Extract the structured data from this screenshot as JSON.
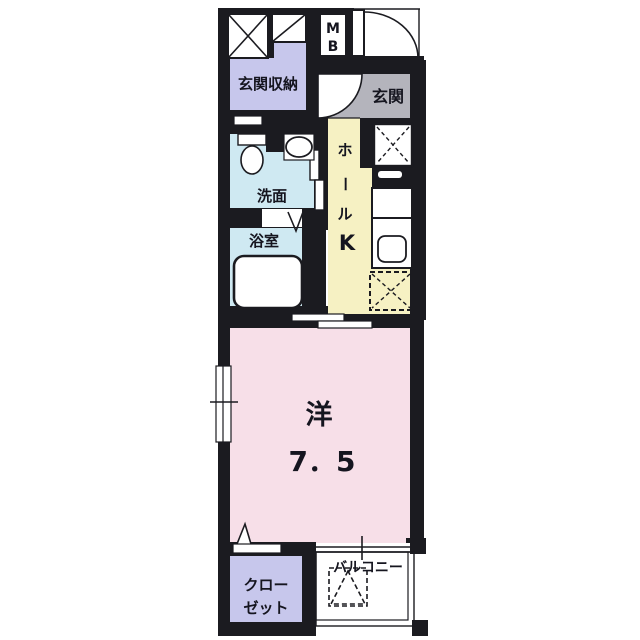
{
  "title": "apartment-floorplan",
  "colors": {
    "wall": "#1b1b20",
    "lavender": "#c7c7ec",
    "gray": "#b4b4bc",
    "blue": "#cfe9f2",
    "yellow": "#f6f1c3",
    "pink": "#f7dfe8",
    "white": "#ffffff",
    "text": "#15151f"
  },
  "rooms": {
    "entrance_storage": {
      "label": "玄関収納"
    },
    "meter_box": {
      "letter_m": "M",
      "letter_b": "B"
    },
    "entrance": {
      "label": "玄関"
    },
    "washroom": {
      "label": "洗面"
    },
    "bathroom": {
      "label": "浴室"
    },
    "hall": {
      "char1": "ホ",
      "char2": "ー",
      "char3": "ル"
    },
    "kitchen": {
      "label": "K"
    },
    "western_room": {
      "label": "洋",
      "size": "7．5"
    },
    "closet": {
      "line1": "クロー",
      "line2": "ゼット"
    },
    "balcony": {
      "label": "バルコニー"
    }
  }
}
